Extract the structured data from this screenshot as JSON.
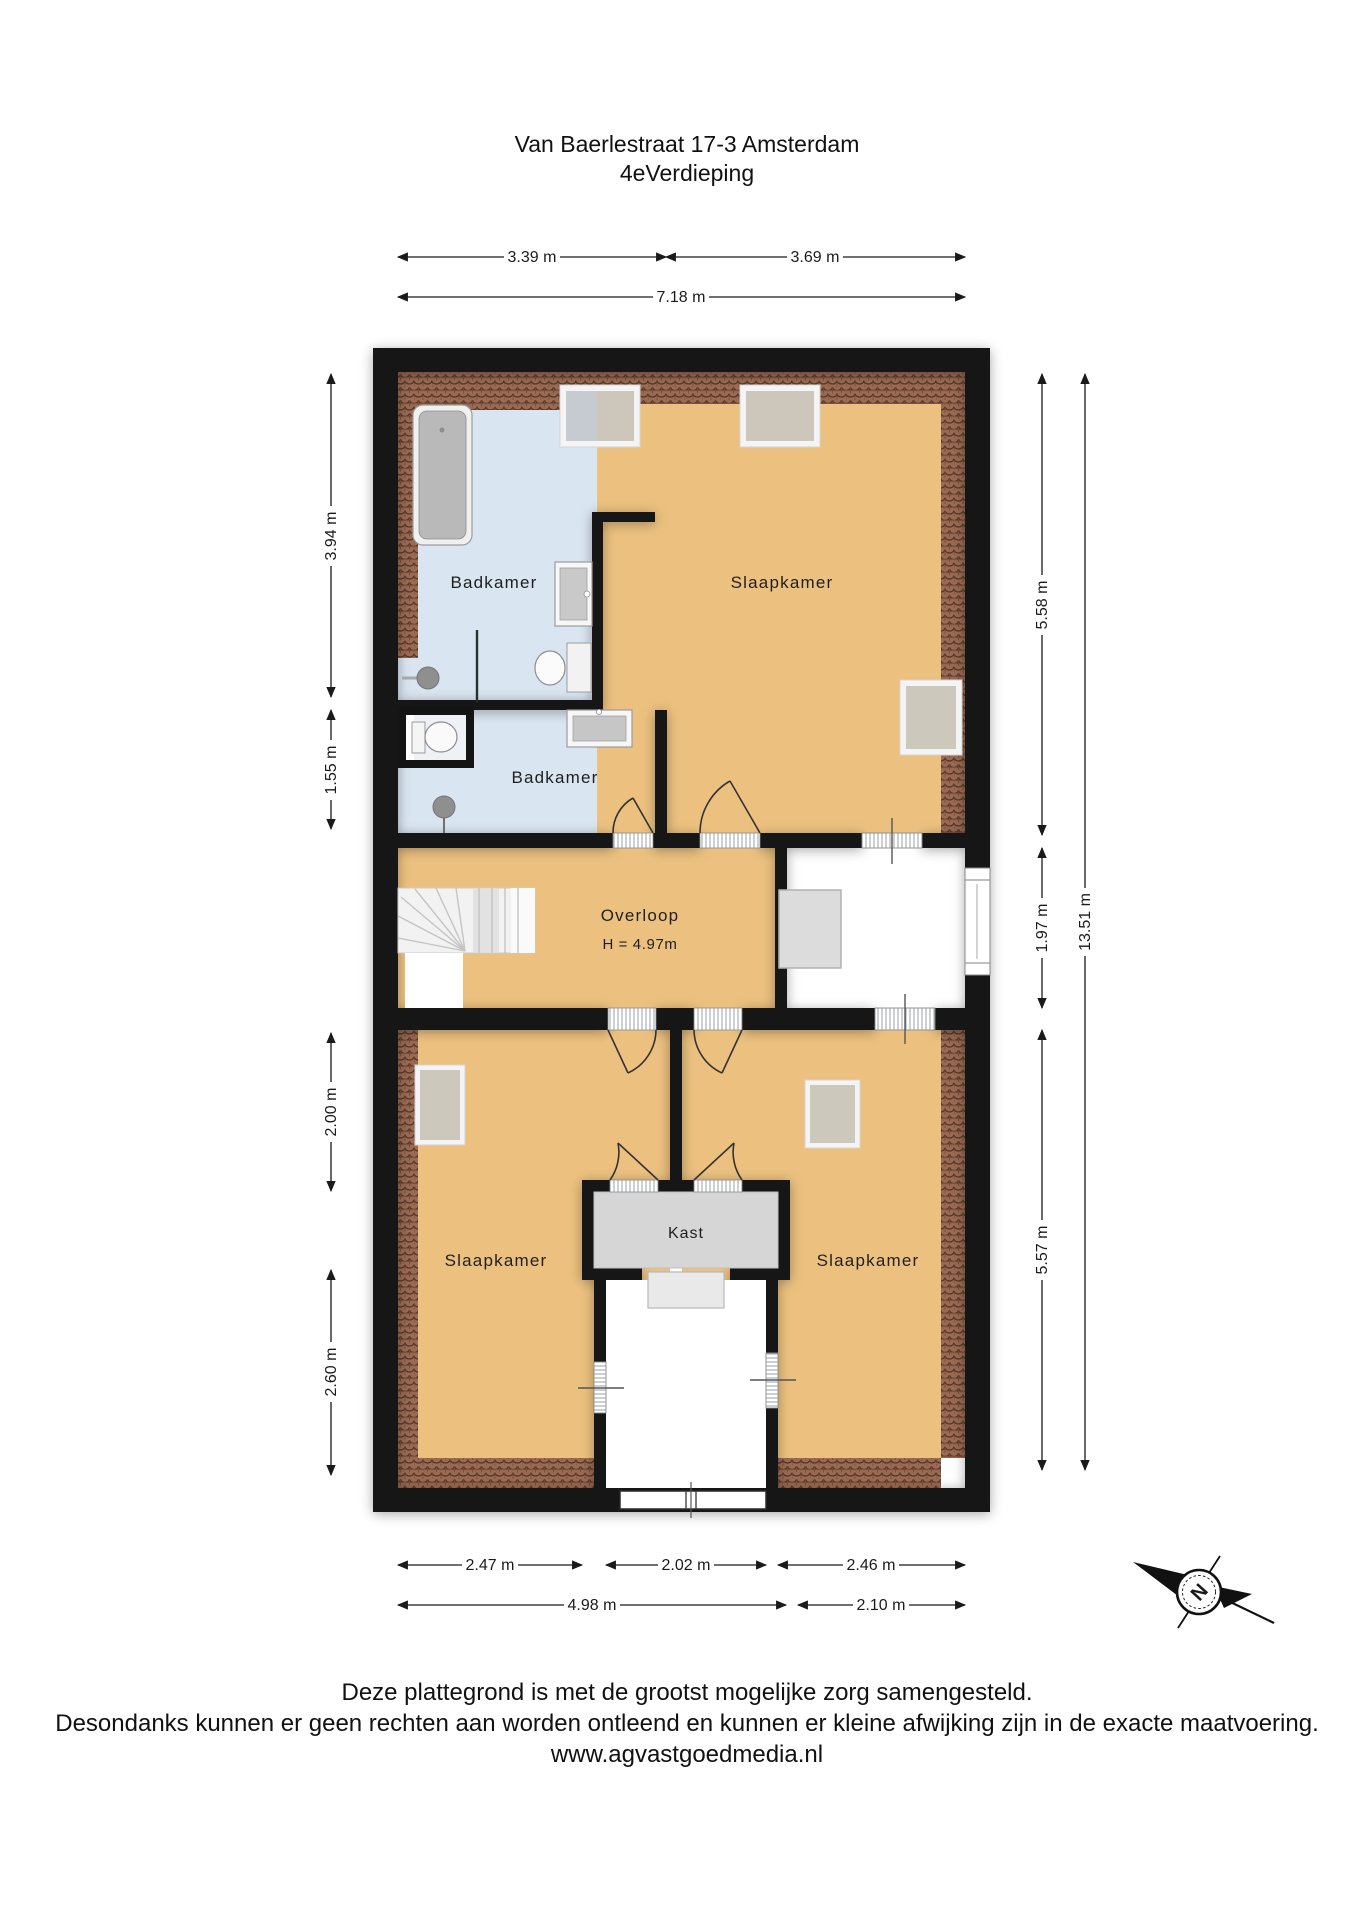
{
  "title": {
    "line1": "Van Baerlestraat 17-3 Amsterdam",
    "line2": "4eVerdieping"
  },
  "floorplan": {
    "rooms": {
      "badkamer_top": "Badkamer",
      "badkamer_mid": "Badkamer",
      "slaapkamer_top": "Slaapkamer",
      "overloop": "Overloop",
      "overloop_ceiling_height": "H = 4.97m",
      "slaapkamer_left": "Slaapkamer",
      "slaapkamer_right": "Slaapkamer",
      "kast": "Kast"
    },
    "colors": {
      "wall": "#141414",
      "room_floor": "#ecc180",
      "bathroom_floor": "#d9e5f1",
      "roof_tiles": "#9c6a53",
      "kast_floor": "#d6d6d6",
      "outside": "#ffffff"
    }
  },
  "dimensions": {
    "top": [
      {
        "label": "3.39 m"
      },
      {
        "label": "3.69 m"
      },
      {
        "label": "7.18 m"
      }
    ],
    "left": [
      {
        "label": "3.94 m"
      },
      {
        "label": "1.55 m"
      },
      {
        "label": "2.00 m"
      },
      {
        "label": "2.60 m"
      }
    ],
    "right": [
      {
        "label": "5.58 m"
      },
      {
        "label": "1.97 m"
      },
      {
        "label": "5.57 m"
      },
      {
        "label": "13.51 m"
      }
    ],
    "bottom": [
      {
        "label": "2.47 m"
      },
      {
        "label": "2.02 m"
      },
      {
        "label": "2.46 m"
      },
      {
        "label": "4.98 m"
      },
      {
        "label": "2.10 m"
      }
    ]
  },
  "compass": {
    "north_label": "N"
  },
  "footer": {
    "line1": "Deze plattegrond is met de grootst mogelijke zorg samengesteld.",
    "line2": "Desondanks kunnen er geen rechten aan worden ontleend en kunnen er kleine afwijking zijn in de exacte maatvoering.",
    "line3": "www.agvastgoedmedia.nl"
  }
}
